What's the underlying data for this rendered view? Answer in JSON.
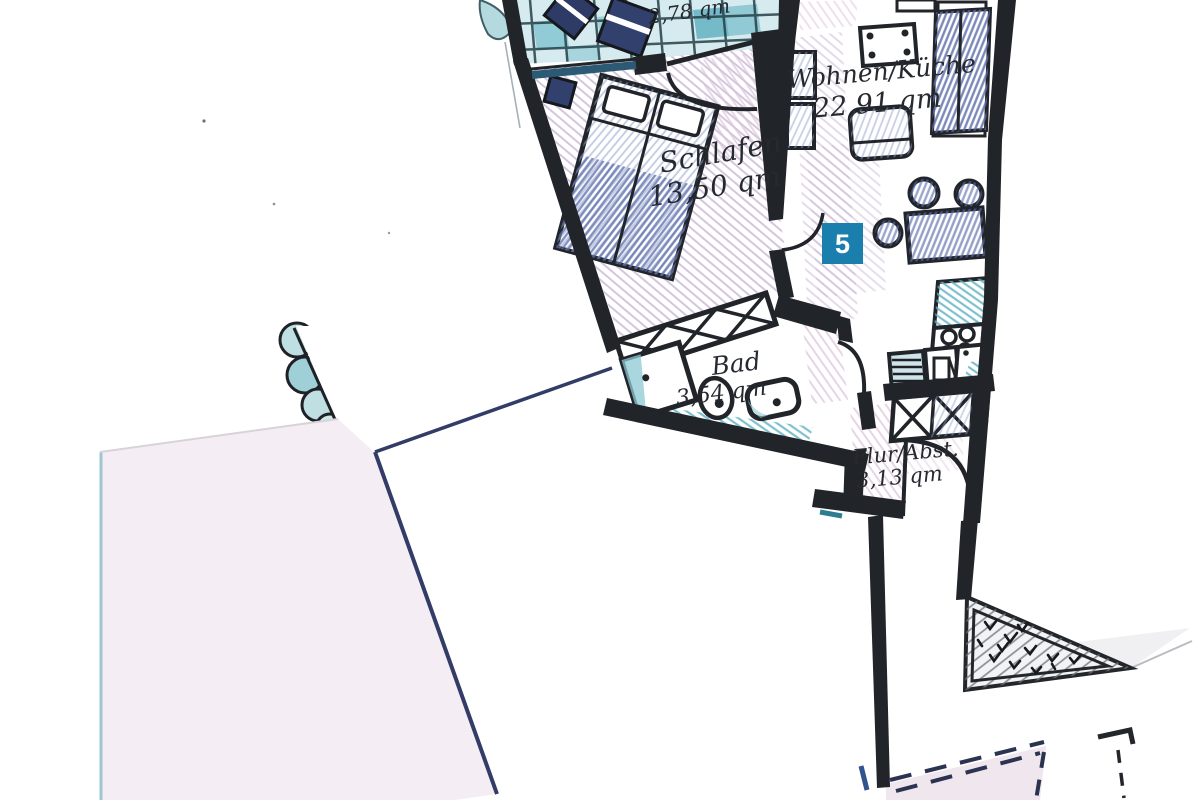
{
  "plan": {
    "badge": {
      "number": "5",
      "background": "#1b7fae",
      "text_color": "#ffffff"
    },
    "rooms": {
      "balcony": {
        "area": "2,78 qm"
      },
      "bedroom": {
        "name": "Schlafen",
        "area": "13,50 qm"
      },
      "living_kitchen": {
        "name": "Wohnen/Küche",
        "area": "22,91 qm"
      },
      "bathroom": {
        "name": "Bad",
        "area": "3,54 qm"
      },
      "hallway": {
        "name": "Flur/Abst.",
        "area": "3,13 qm"
      }
    },
    "colors": {
      "wall_ink": "#212429",
      "pencil_navy": "#33406d",
      "tile_teal": "#7fc3cf",
      "shading_purple": "#c2add0",
      "shading_pink": "#dcc2d8",
      "paper_overlay": "#f4eef4"
    }
  }
}
